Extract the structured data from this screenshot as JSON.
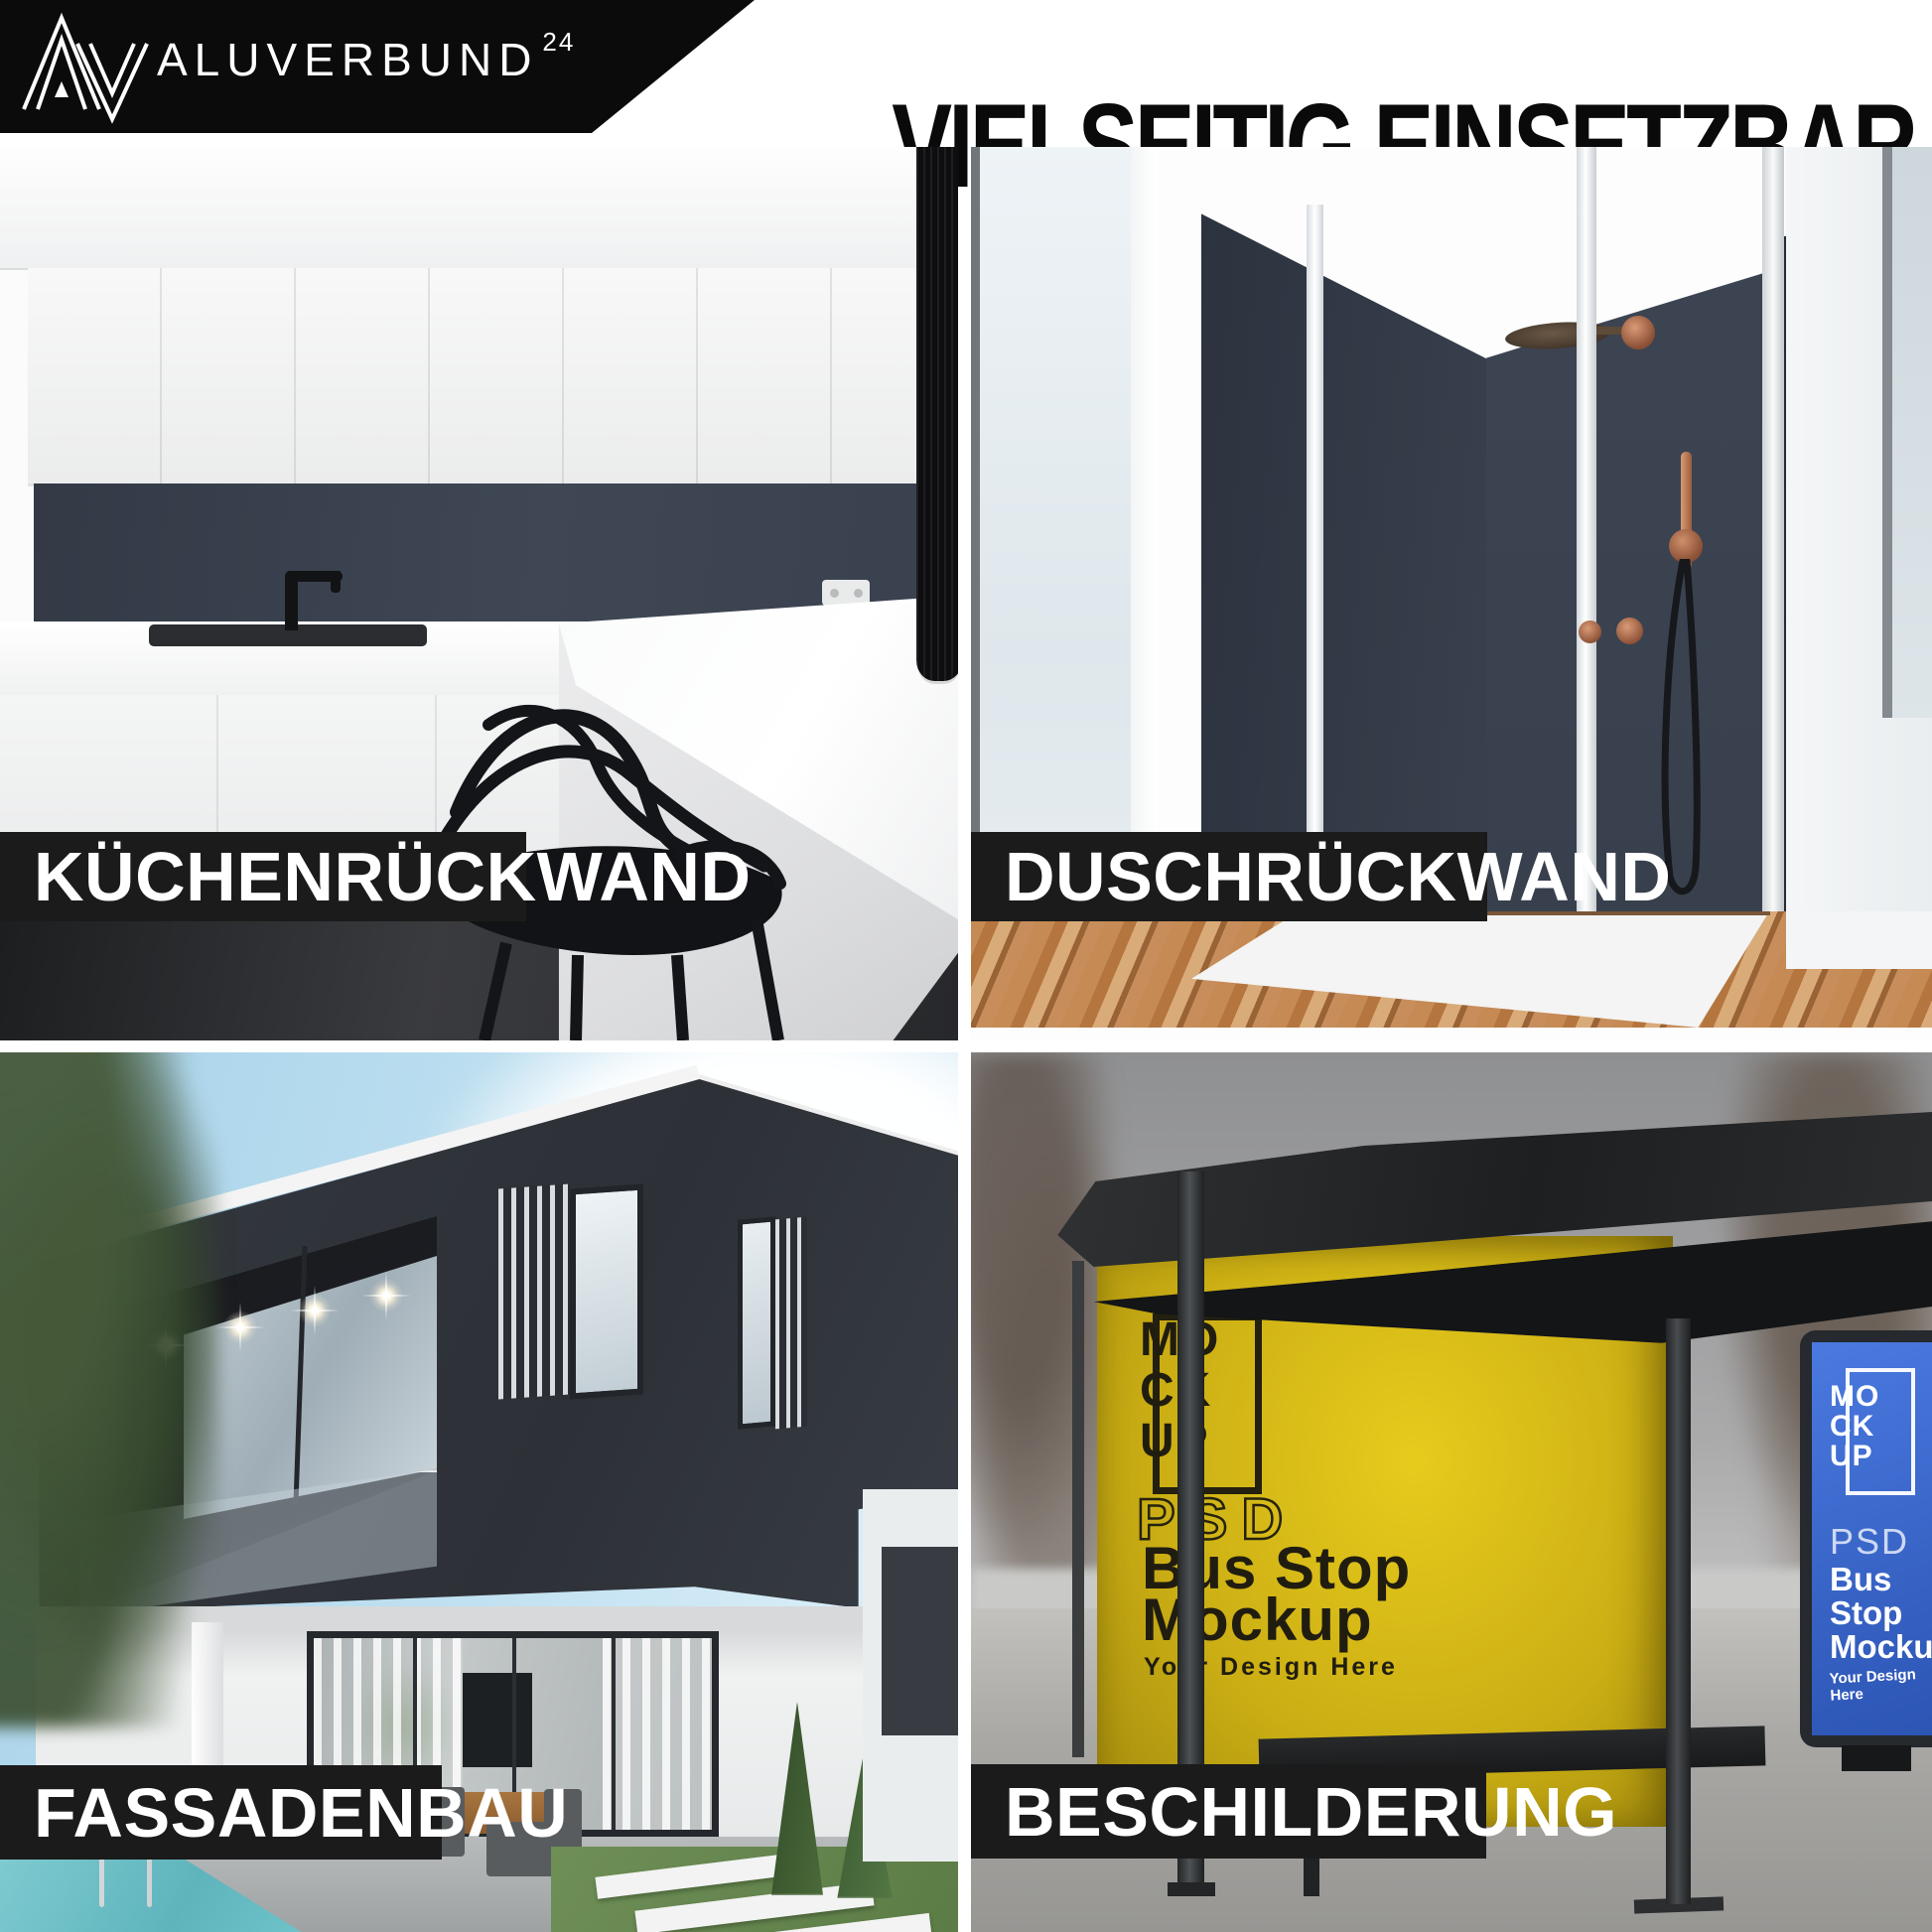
{
  "header": {
    "logo": {
      "brand": "ALUVERBUND",
      "superscript": "24"
    },
    "title": "VIELSEITIG EINSETZBAR"
  },
  "tiles": [
    {
      "id": "kuechenrueckwand",
      "label": "KÜCHENRÜCKWAND"
    },
    {
      "id": "duschrueckwand",
      "label": "DUSCHRÜCKWAND"
    },
    {
      "id": "fassadenbau",
      "label": "FASSADENBAU"
    },
    {
      "id": "beschilderung",
      "label": "BESCHILDERUNG"
    }
  ],
  "posters": {
    "yellow": {
      "logo_rows": [
        "MO",
        "CK",
        "UP"
      ],
      "psd": "PSD",
      "line1": "Bus Stop",
      "line2": "Mockup",
      "tagline": "Your Design Here"
    },
    "blue": {
      "logo_rows": [
        "MO",
        "CK",
        "UP"
      ],
      "psd": "PSD",
      "line1": "Bus",
      "line2": "Stop",
      "line3": "Mockup",
      "tagline": "Your Design Here"
    }
  },
  "colors": {
    "banner_black": "#0b0b0b",
    "label_bar": "#1b1b1b",
    "anthracite_panel": "#3a4150",
    "poster_yellow": "#d7bb16",
    "poster_blue": "#3a67cf",
    "wood_floor": "#b97c4e",
    "pool_water": "#6fc3c9"
  }
}
